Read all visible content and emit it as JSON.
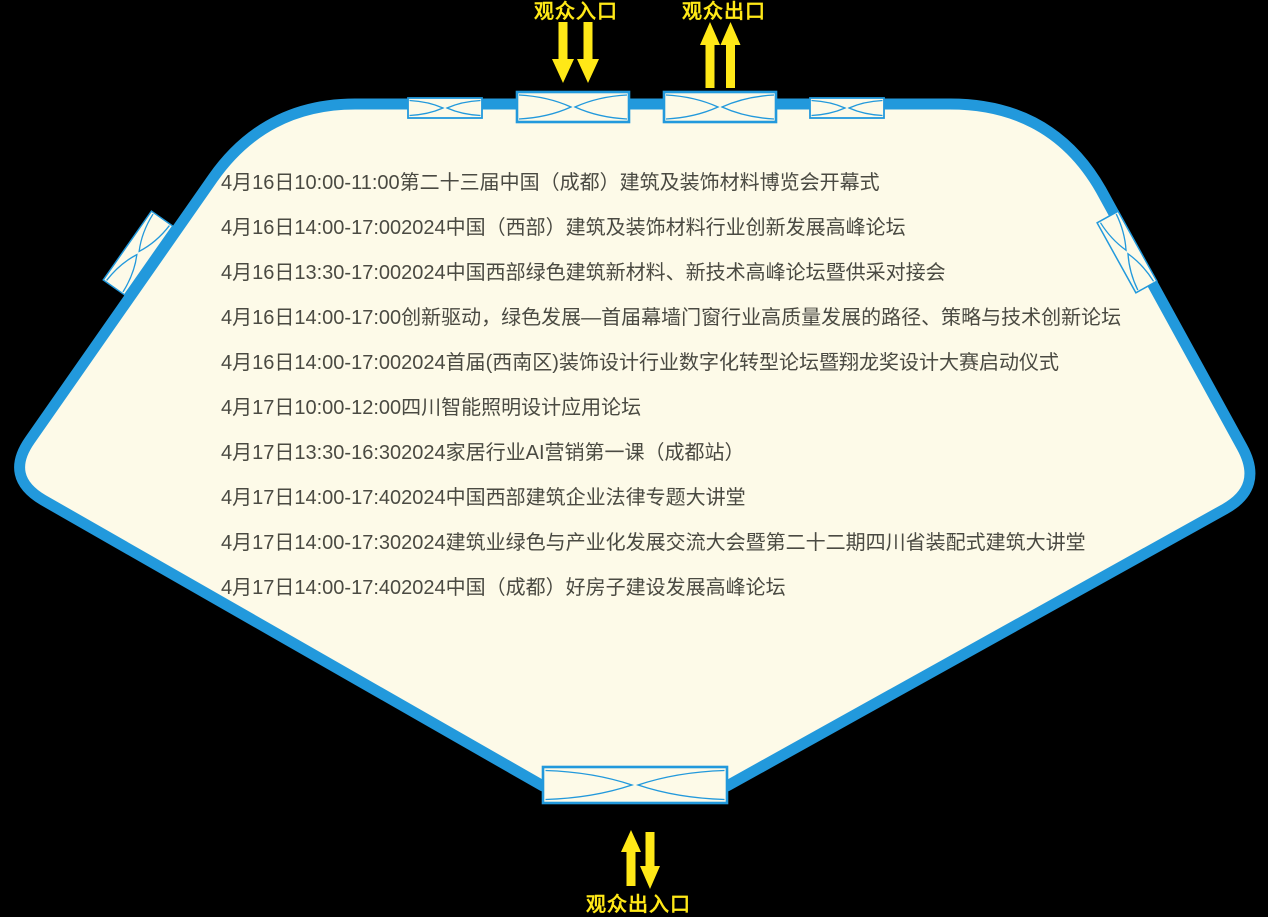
{
  "colors": {
    "background": "#000000",
    "hall_fill": "#FDFAE8",
    "border_blue": "#2299DC",
    "text_dark": "#4A4A42",
    "accent_yellow": "#FFE817"
  },
  "labels": {
    "entrance_top": "观众入口",
    "exit_top": "观众出口",
    "entrance_exit_bottom": "观众出入口"
  },
  "icons": {
    "door": "double-swing-door-plan-icon",
    "entrance_arrows": "double-down-arrow-icon",
    "exit_arrows": "double-up-arrow-icon",
    "bottom_arrows": "up-down-arrow-icon"
  },
  "schedule": [
    {
      "time": "4月16日10:00-11:00",
      "event": "第二十三届中国（成都）建筑及装饰材料博览会开幕式"
    },
    {
      "time": "4月16日14:00-17:00",
      "event": "2024中国（西部）建筑及装饰材料行业创新发展高峰论坛"
    },
    {
      "time": "4月16日13:30-17:00",
      "event": "2024中国西部绿色建筑新材料、新技术高峰论坛暨供采对接会"
    },
    {
      "time": "4月16日14:00-17:00",
      "event": "创新驱动，绿色发展—首届幕墙门窗行业高质量发展的路径、策略与技术创新论坛"
    },
    {
      "time": "4月16日14:00-17:00",
      "event": "2024首届(西南区)装饰设计行业数字化转型论坛暨翔龙奖设计大赛启动仪式"
    },
    {
      "time": "4月17日10:00-12:00",
      "event": "四川智能照明设计应用论坛"
    },
    {
      "time": "4月17日13:30-16:30",
      "event": "2024家居行业AI营销第一课（成都站）"
    },
    {
      "time": "4月17日14:00-17:40",
      "event": "2024中国西部建筑企业法律专题大讲堂"
    },
    {
      "time": "4月17日14:00-17:30",
      "event": "2024建筑业绿色与产业化发展交流大会暨第二十二期四川省装配式建筑大讲堂"
    },
    {
      "time": "4月17日14:00-17:40",
      "event": "2024中国（成都）好房子建设发展高峰论坛"
    }
  ]
}
